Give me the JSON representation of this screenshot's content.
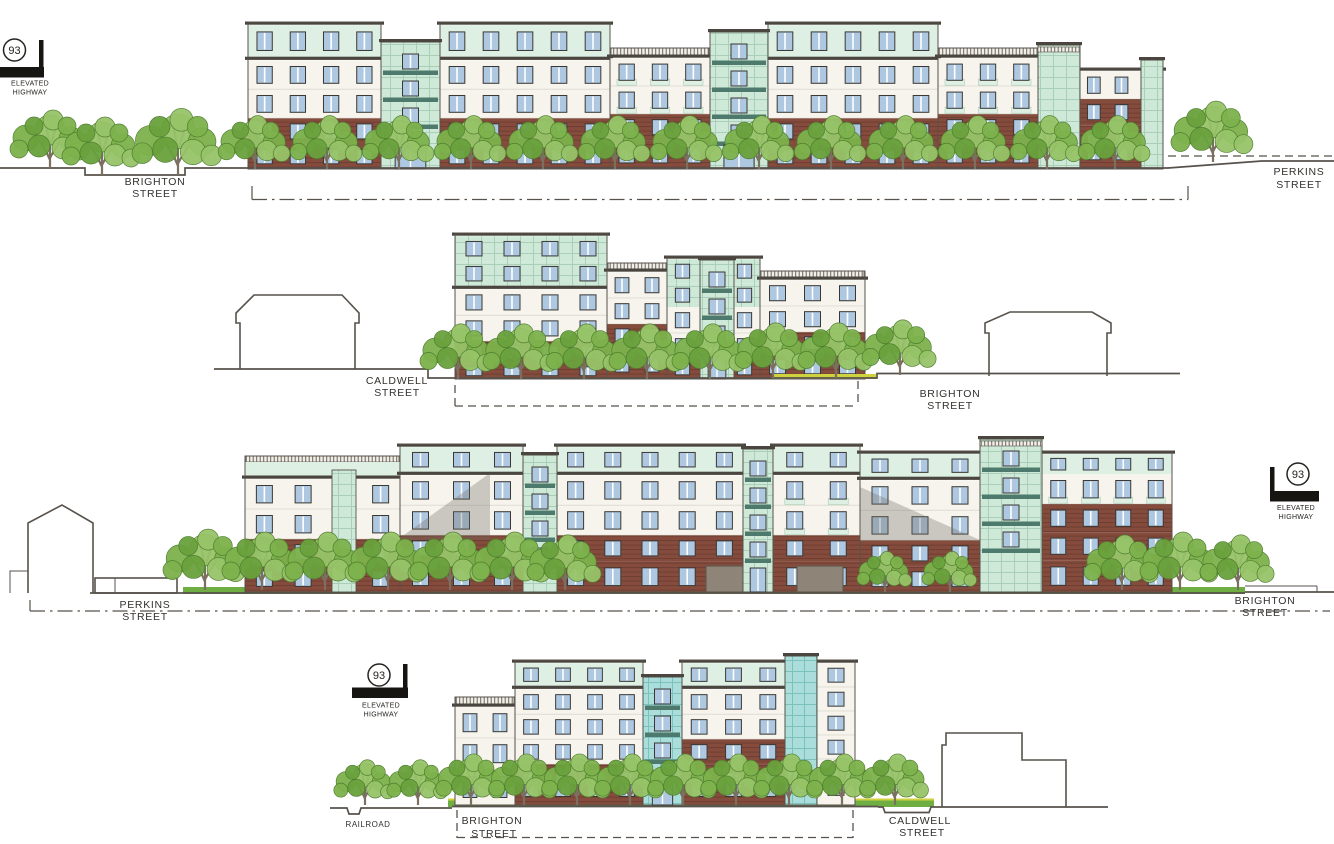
{
  "sheet": {
    "description": "Architectural street elevations, four stacked building elevation drawings"
  },
  "colors": {
    "line": "#57524b",
    "dark_line": "#3b3833",
    "cornice": "#4a453e",
    "brick": "#854c3e",
    "brick_mortar": "rgba(50,22,12,0.28)",
    "facade": "#f6f4ed",
    "floor_line": "#c9c5ba",
    "mint": "#cfe9d8",
    "mint_wall": "#ddf0e3",
    "mint_grid": "#a9cfb8",
    "teal": "#abdedb",
    "teal_grid": "#7dc1bd",
    "teal_dark": "#4d7a6c",
    "glass": "#afc8e2",
    "tree": "#7db24c",
    "tree2": "#97c468",
    "tree3": "#6aa23d",
    "tree_line": "#4d7c2e",
    "trunk": "#7b7060",
    "grass": "#6fae43",
    "ystrip": "#cfd23d",
    "garage": "#8f8478",
    "shadow": "rgba(110,105,95,0.32)",
    "rail_bg": "#f1efe7",
    "highway": "#171512"
  },
  "elevations": [
    {
      "name": "elevation-1",
      "left_label": {
        "line1": "BRIGHTON",
        "line2": "STREET"
      },
      "right_label": {
        "line1": "PERKINS",
        "line2": "STREET"
      },
      "marker": {
        "route": "93",
        "line1": "ELEVATED",
        "line2": "HIGHWAY"
      }
    },
    {
      "name": "elevation-2",
      "left_label": {
        "line1": "CALDWELL",
        "line2": "STREET"
      },
      "right_label": {
        "line1": "BRIGHTON",
        "line2": "STREET"
      }
    },
    {
      "name": "elevation-3",
      "left_label": {
        "line1": "PERKINS",
        "line2": "STREET"
      },
      "right_label": {
        "line1": "BRIGHTON",
        "line2": "STREET"
      },
      "marker": {
        "route": "93",
        "line1": "ELEVATED",
        "line2": "HIGHWAY"
      }
    },
    {
      "name": "elevation-4",
      "left_label": {
        "line1": "RAILROAD",
        "line2": ""
      },
      "center_label": {
        "line1": "BRIGHTON",
        "line2": "STREET"
      },
      "right_label": {
        "line1": "CALDWELL",
        "line2": "STREET"
      },
      "marker": {
        "route": "93",
        "line1": "ELEVATED",
        "line2": "HIGHWAY"
      }
    }
  ]
}
